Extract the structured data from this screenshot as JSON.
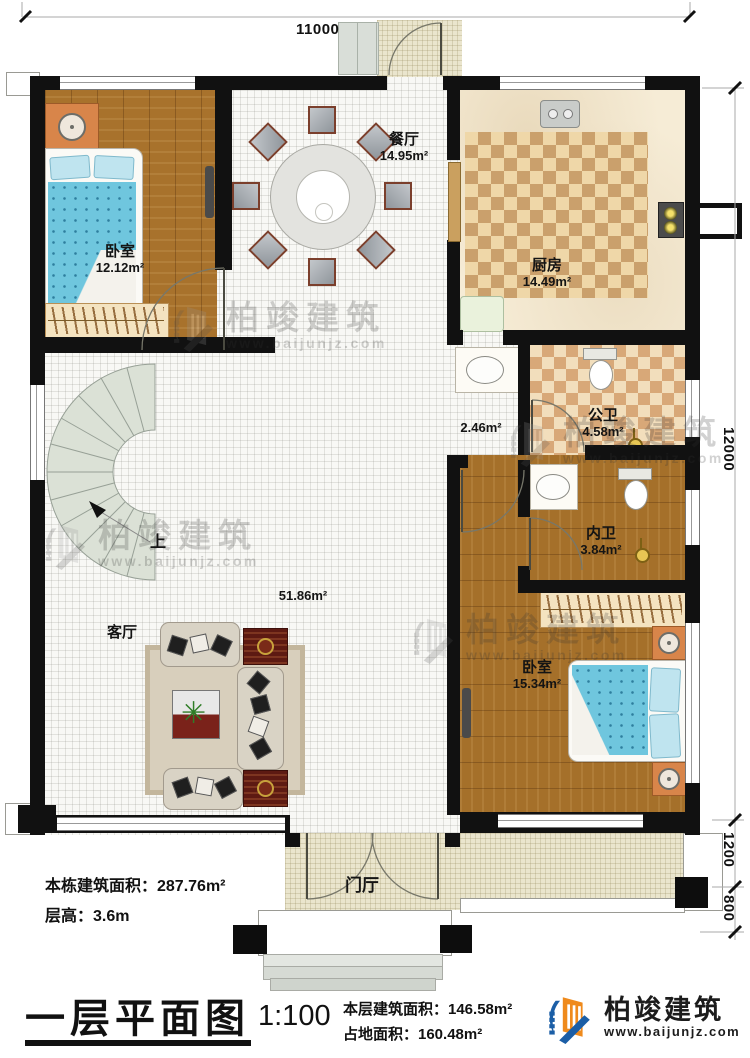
{
  "brand": {
    "name": "柏竣建筑",
    "website": "www.baijunjz.com"
  },
  "title_block": {
    "plan_title": "一层平面图",
    "scale": "1:100",
    "floor_area": "本层建筑面积：146.58m²",
    "land_area": "占地面积：160.48m²"
  },
  "notes": {
    "building_area": "本栋建筑面积：287.76m²",
    "floor_height": "层高：3.6m"
  },
  "dimensions": {
    "top": "11000",
    "right_main": "12000",
    "right_upper": "1200",
    "right_lower": "800"
  },
  "rooms": {
    "bedroom1": {
      "name": "卧室",
      "area": "12.12m²"
    },
    "dining": {
      "name": "餐厅",
      "area": "14.95m²"
    },
    "kitchen": {
      "name": "厨房",
      "area": "14.49m²"
    },
    "hallway": {
      "area": "2.46m²"
    },
    "public_bath": {
      "name": "公卫",
      "area": "4.58m²"
    },
    "ensuite_bath": {
      "name": "内卫",
      "area": "3.84m²"
    },
    "living": {
      "name": "客厅",
      "area": "51.86m²"
    },
    "bedroom2": {
      "name": "卧室",
      "area": "15.34m²"
    },
    "foyer": {
      "name": "门厅"
    },
    "stair": {
      "up_label": "上"
    }
  },
  "colors": {
    "wall": "#111111",
    "wood_floor": "#a8722c",
    "checker_tile": "#cf9f6f",
    "bed_blue": "#6fc6de",
    "stair_tread": "#dbe1d6",
    "brand_blue": "#1b5ea6",
    "brand_orange": "#ef8a1c"
  }
}
